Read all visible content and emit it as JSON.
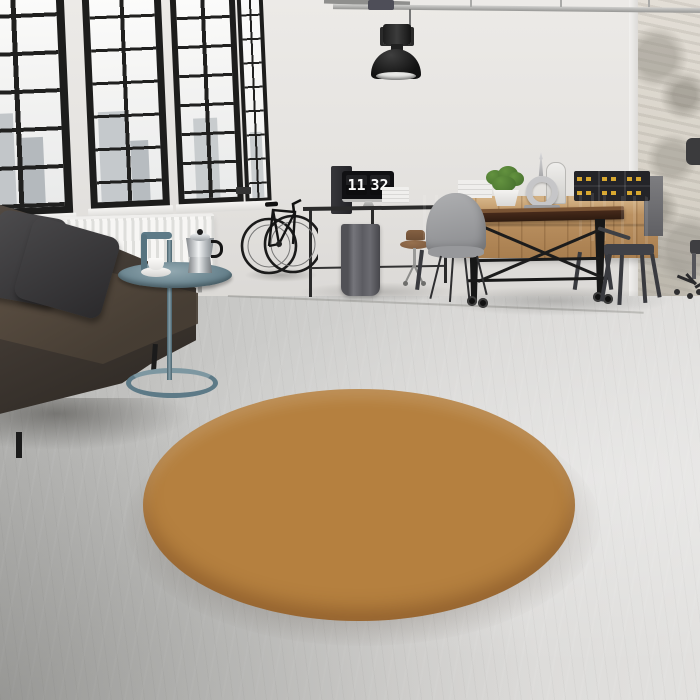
{
  "scene": {
    "description": "Industrial loft interior with black-framed windows, leather sofa, bicycle, desk with flip clock, wooden dining set and a round patchwork rug",
    "clock": {
      "hours": "11",
      "minutes": "32"
    },
    "palette": {
      "wall": "#e4e2df",
      "floor_concrete": "#cfcfcd",
      "window_frame": "#1d1d1c",
      "radiator": "#f6f5f3",
      "sofa_leather": "#3e3731",
      "pillow": "#38373a",
      "side_table_metal": "#5d7a87",
      "moka_pot": "#c9cdd0",
      "lamp": "#1a1a1a",
      "pipe": "#b0b0ae",
      "monitor_screen": "#101013",
      "clock_digits": "#fafafa",
      "sideboard_wood": "#b8905f",
      "table_wood": "#45291a",
      "table_frame": "#1a1a1a",
      "chair_metal_gray": "#4b4c51",
      "chair_shell_gray": "#9b9c9f",
      "storage_box": "#242428",
      "box_latch": "#d8a830",
      "plant": "#4f7c33",
      "lantern_silver": "#c6c6c8",
      "distressed_wall": "#d8d3c9"
    },
    "rug": {
      "shape": "round",
      "pattern": "beveled patchwork squares",
      "groove": "#b5803f",
      "grid": [
        [
          "#d9a868",
          "#7d8c33",
          "#e09478",
          "#d0a271",
          "#e8bb93",
          "#e5cfa6",
          "#cf8d4e",
          "#d9a96e",
          "#c98e55"
        ],
        [
          "#e2bd8c",
          "#503a22",
          "#ead3ab",
          "#e2a877",
          "#ecd6b0",
          "#e5b184",
          "#d8a568",
          "#c98648",
          "#d7a263"
        ],
        [
          "#e6cda4",
          "#e7b58a",
          "#ecd8b4",
          "#d8a770",
          "#e9bb90",
          "#e8d0aa",
          "#5d4226",
          "#d3973f",
          "#b5742f"
        ],
        [
          "#e2ab7d",
          "#e9d2ae",
          "#dca96f",
          "#e6b286",
          "#ead6b2",
          "#d5a062",
          "#4f371f",
          "#a13a33",
          "#8a5a2a"
        ],
        [
          "#dd8f6c",
          "#e5b488",
          "#ead3ad",
          "#d8876a",
          "#e7cfa8",
          "#d29c5e",
          "#cf9a45",
          "#9a3832",
          "#6e4524"
        ],
        [
          "#dcae78",
          "#e8d0ab",
          "#d2795c",
          "#e2ae80",
          "#d8a469",
          "#d49e4a",
          "#a33b33",
          "#7a4a28",
          "#9c3b31"
        ],
        [
          "#dd9f42",
          "#e6cda6",
          "#c9755a",
          "#d98364",
          "#d9a145",
          "#cc8a3f",
          "#93312d",
          "#6b4526",
          "#a04a35"
        ],
        [
          "#e0a049",
          "#ddb988",
          "#d6846a",
          "#cf7a5e",
          "#d9a556",
          "#c98a45",
          "#8e3a2e",
          "#7a4a28",
          "#b5742f"
        ]
      ]
    }
  }
}
